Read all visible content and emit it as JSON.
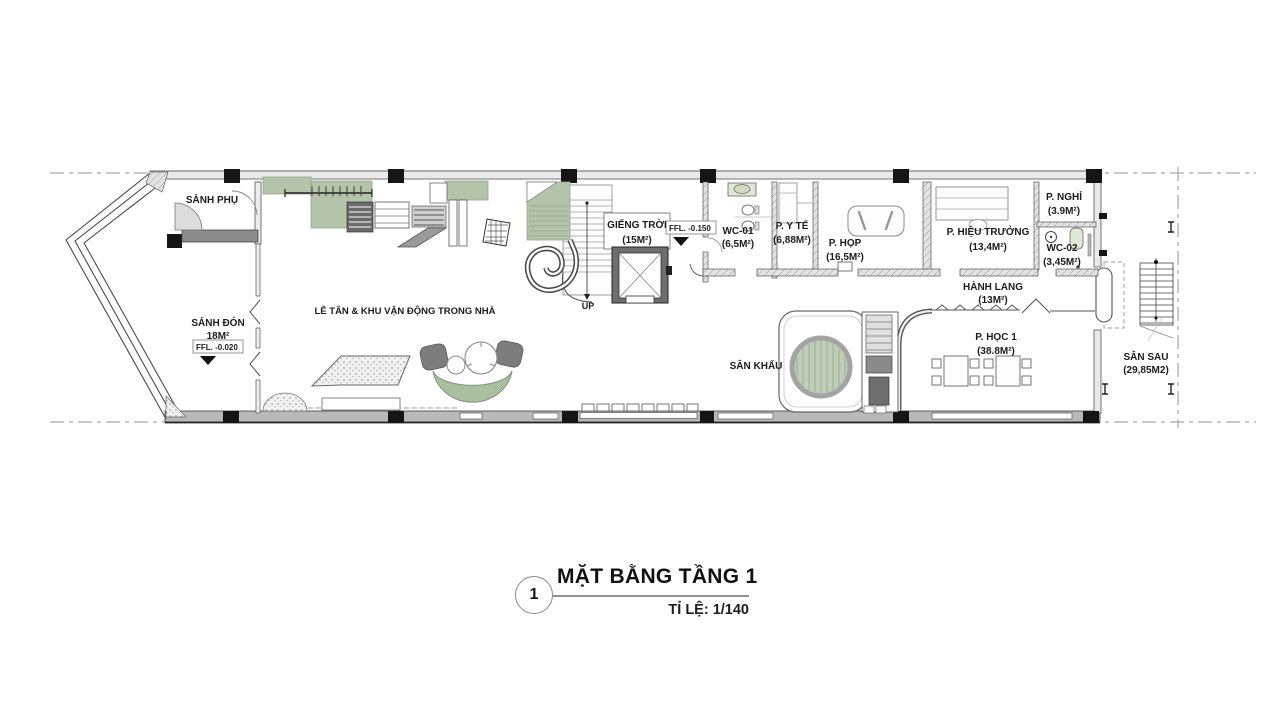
{
  "drawing": {
    "title": "MẶT BẰNG TẦNG 1",
    "sheet_number": "1",
    "scale_label": "TỈ LỆ: 1/140"
  },
  "rooms": {
    "sanh_phu": {
      "name": "SẢNH PHỤ"
    },
    "sanh_don": {
      "name": "SẢNH ĐÓN",
      "area": "18M²"
    },
    "le_tan": {
      "name": "LỄ TÂN & KHU VẬN ĐỘNG TRONG NHÀ"
    },
    "gieng_troi": {
      "name": "GIẾNG TRỜI",
      "area": "(15M²)"
    },
    "wc_01": {
      "name": "WC-01",
      "area": "(6,5M²)"
    },
    "p_y_te": {
      "name": "P. Y TẾ",
      "area": "(6,88M²)"
    },
    "p_hop": {
      "name": "P. HỌP",
      "area": "(16,5M²)"
    },
    "p_hieu_truong": {
      "name": "P. HIỆU TRƯỞNG",
      "area": "(13,4M²)"
    },
    "p_nghi": {
      "name": "P. NGHỈ",
      "area": "(3.9M²)"
    },
    "wc_02": {
      "name": "WC-02",
      "area": "(3,45M²)"
    },
    "hanh_lang": {
      "name": "HÀNH LANG",
      "area": "(13M²)"
    },
    "p_hoc_1": {
      "name": "P. HỌC 1",
      "area": "(38.8M²)"
    },
    "san_khau": {
      "name": "SÂN KHẤU"
    },
    "san_sau": {
      "name": "SÂN SAU",
      "area": "(29,85M2)"
    }
  },
  "annotations": {
    "up": "UP",
    "ffl_entrance": "FFL.  -0.020",
    "ffl_lobby": "FFL.  -0.150"
  },
  "colors": {
    "mat-green": "#b3c4ab",
    "stage-green": "#bfccb8",
    "wall-gray": "#c2c2c2",
    "furniture-gray": "#8c8c8c",
    "boundary-gray": "#a6a6a6",
    "column-black": "#151515"
  }
}
